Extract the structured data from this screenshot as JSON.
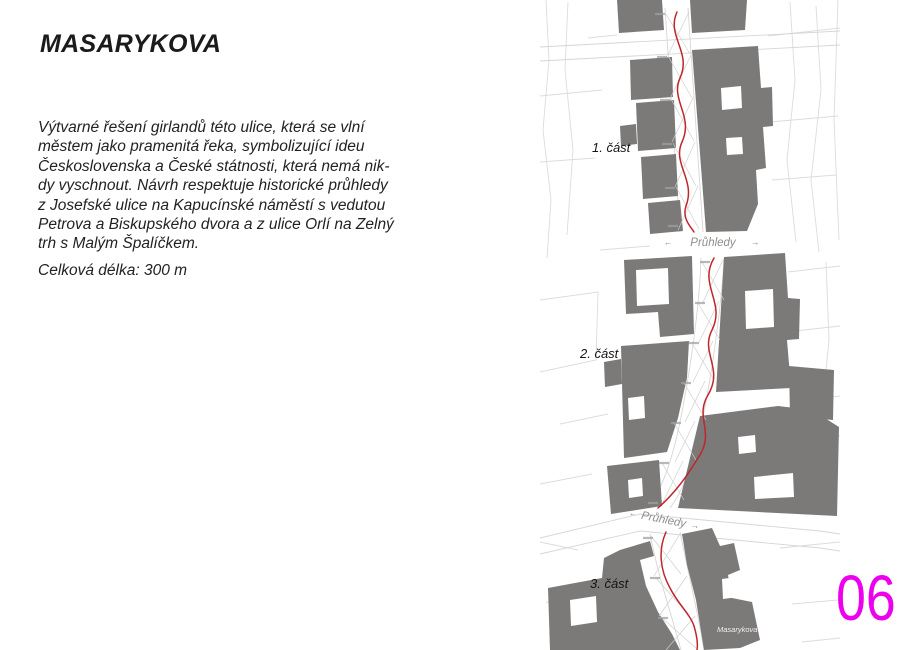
{
  "page": {
    "title": "MASARYKOVA",
    "description": "Výtvarné řešení girlandů této ulice, která se vlní\nměstem jako pramenitá řeka, symbolizující ideu\nČeskoslovenska a České státnosti, která nemá nik-\ndy vyschnout. Návrh respektuje historické průhledy\nz Josefské ulice na Kapucínské náměstí s vedutou\nPetrova a Biskupského dvora a z ulice Orlí na Zelný\ntrh s Malým Špalíčkem.",
    "length_note": "Celková délka: 300 m",
    "page_number": "06"
  },
  "map": {
    "section_labels": [
      "1. část",
      "2. část",
      "3. část"
    ],
    "viewline_label": "Průhledy",
    "arrow_left": "←",
    "arrow_right": "→",
    "street_name": "Masarykova",
    "colors": {
      "building_gray": "#7c7979",
      "parcel_line_gray": "#dcdcdc",
      "route_red": "#c0262c",
      "page_number_magenta": "#ed00ed",
      "viewline_label_gray": "#8f8f8f"
    }
  }
}
